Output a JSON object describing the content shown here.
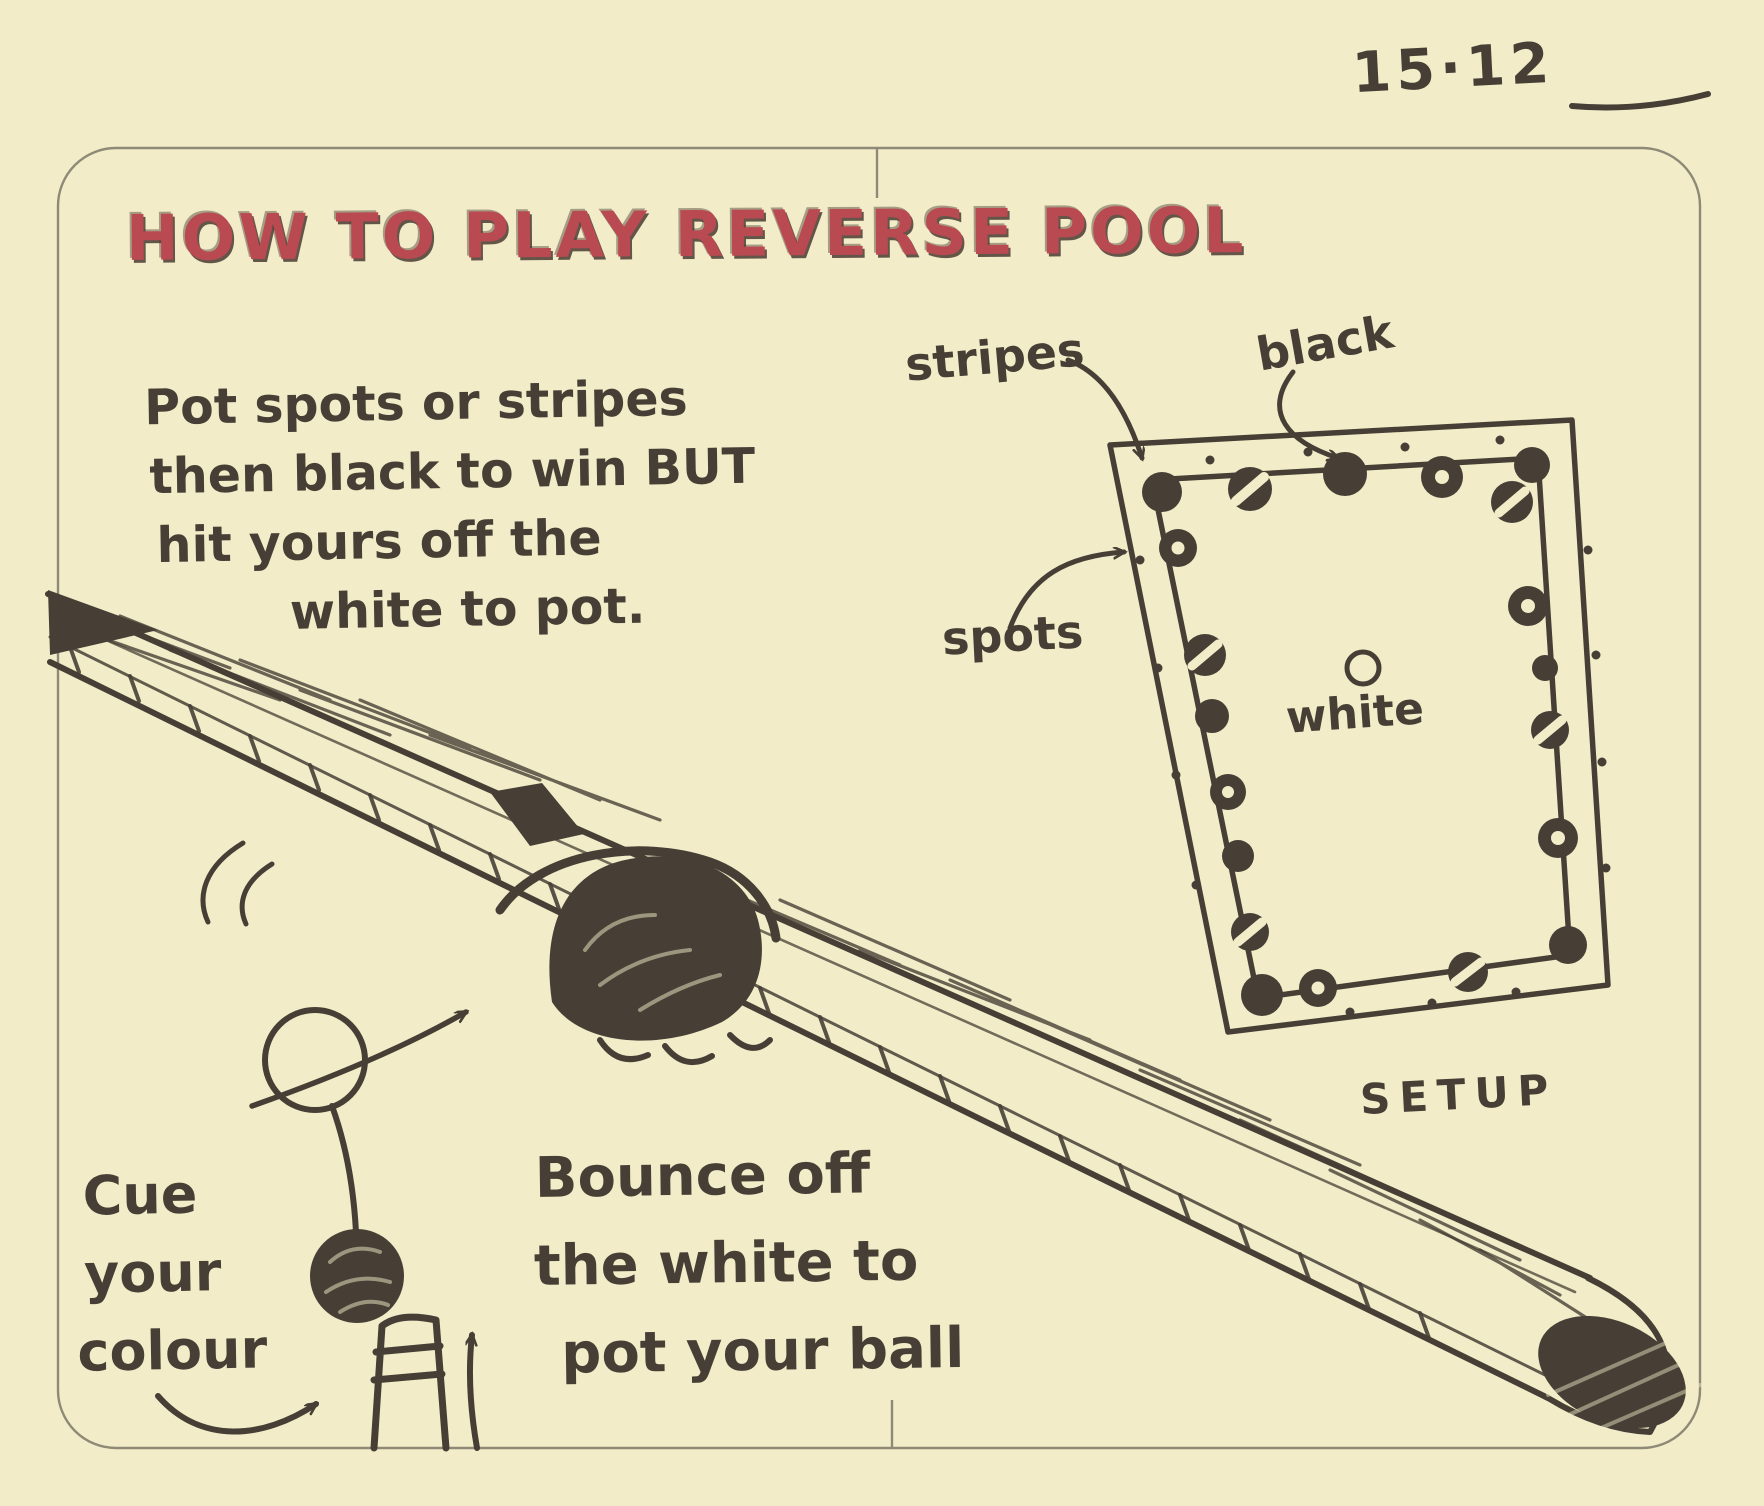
{
  "page": {
    "date": "15·12",
    "title": "HOW TO PLAY REVERSE POOL",
    "rule_lines": [
      "Pot spots or stripes",
      "then black to win BUT",
      "hit yours off the",
      "white to pot."
    ]
  },
  "setup_diagram": {
    "stripes_label": "stripes",
    "black_label": "black",
    "spots_label": "spots",
    "white_label": "white",
    "caption": "SETUP"
  },
  "shot_diagram": {
    "cue_label_lines": [
      "Cue",
      "your",
      "colour"
    ],
    "bounce_lines": [
      "Bounce off",
      "the white to",
      "pot your ball"
    ]
  },
  "colors": {
    "paper": "#f2edc8",
    "ink": "#473f36",
    "title_red": "#b94a52",
    "pencil_border": "#8f8a77"
  }
}
